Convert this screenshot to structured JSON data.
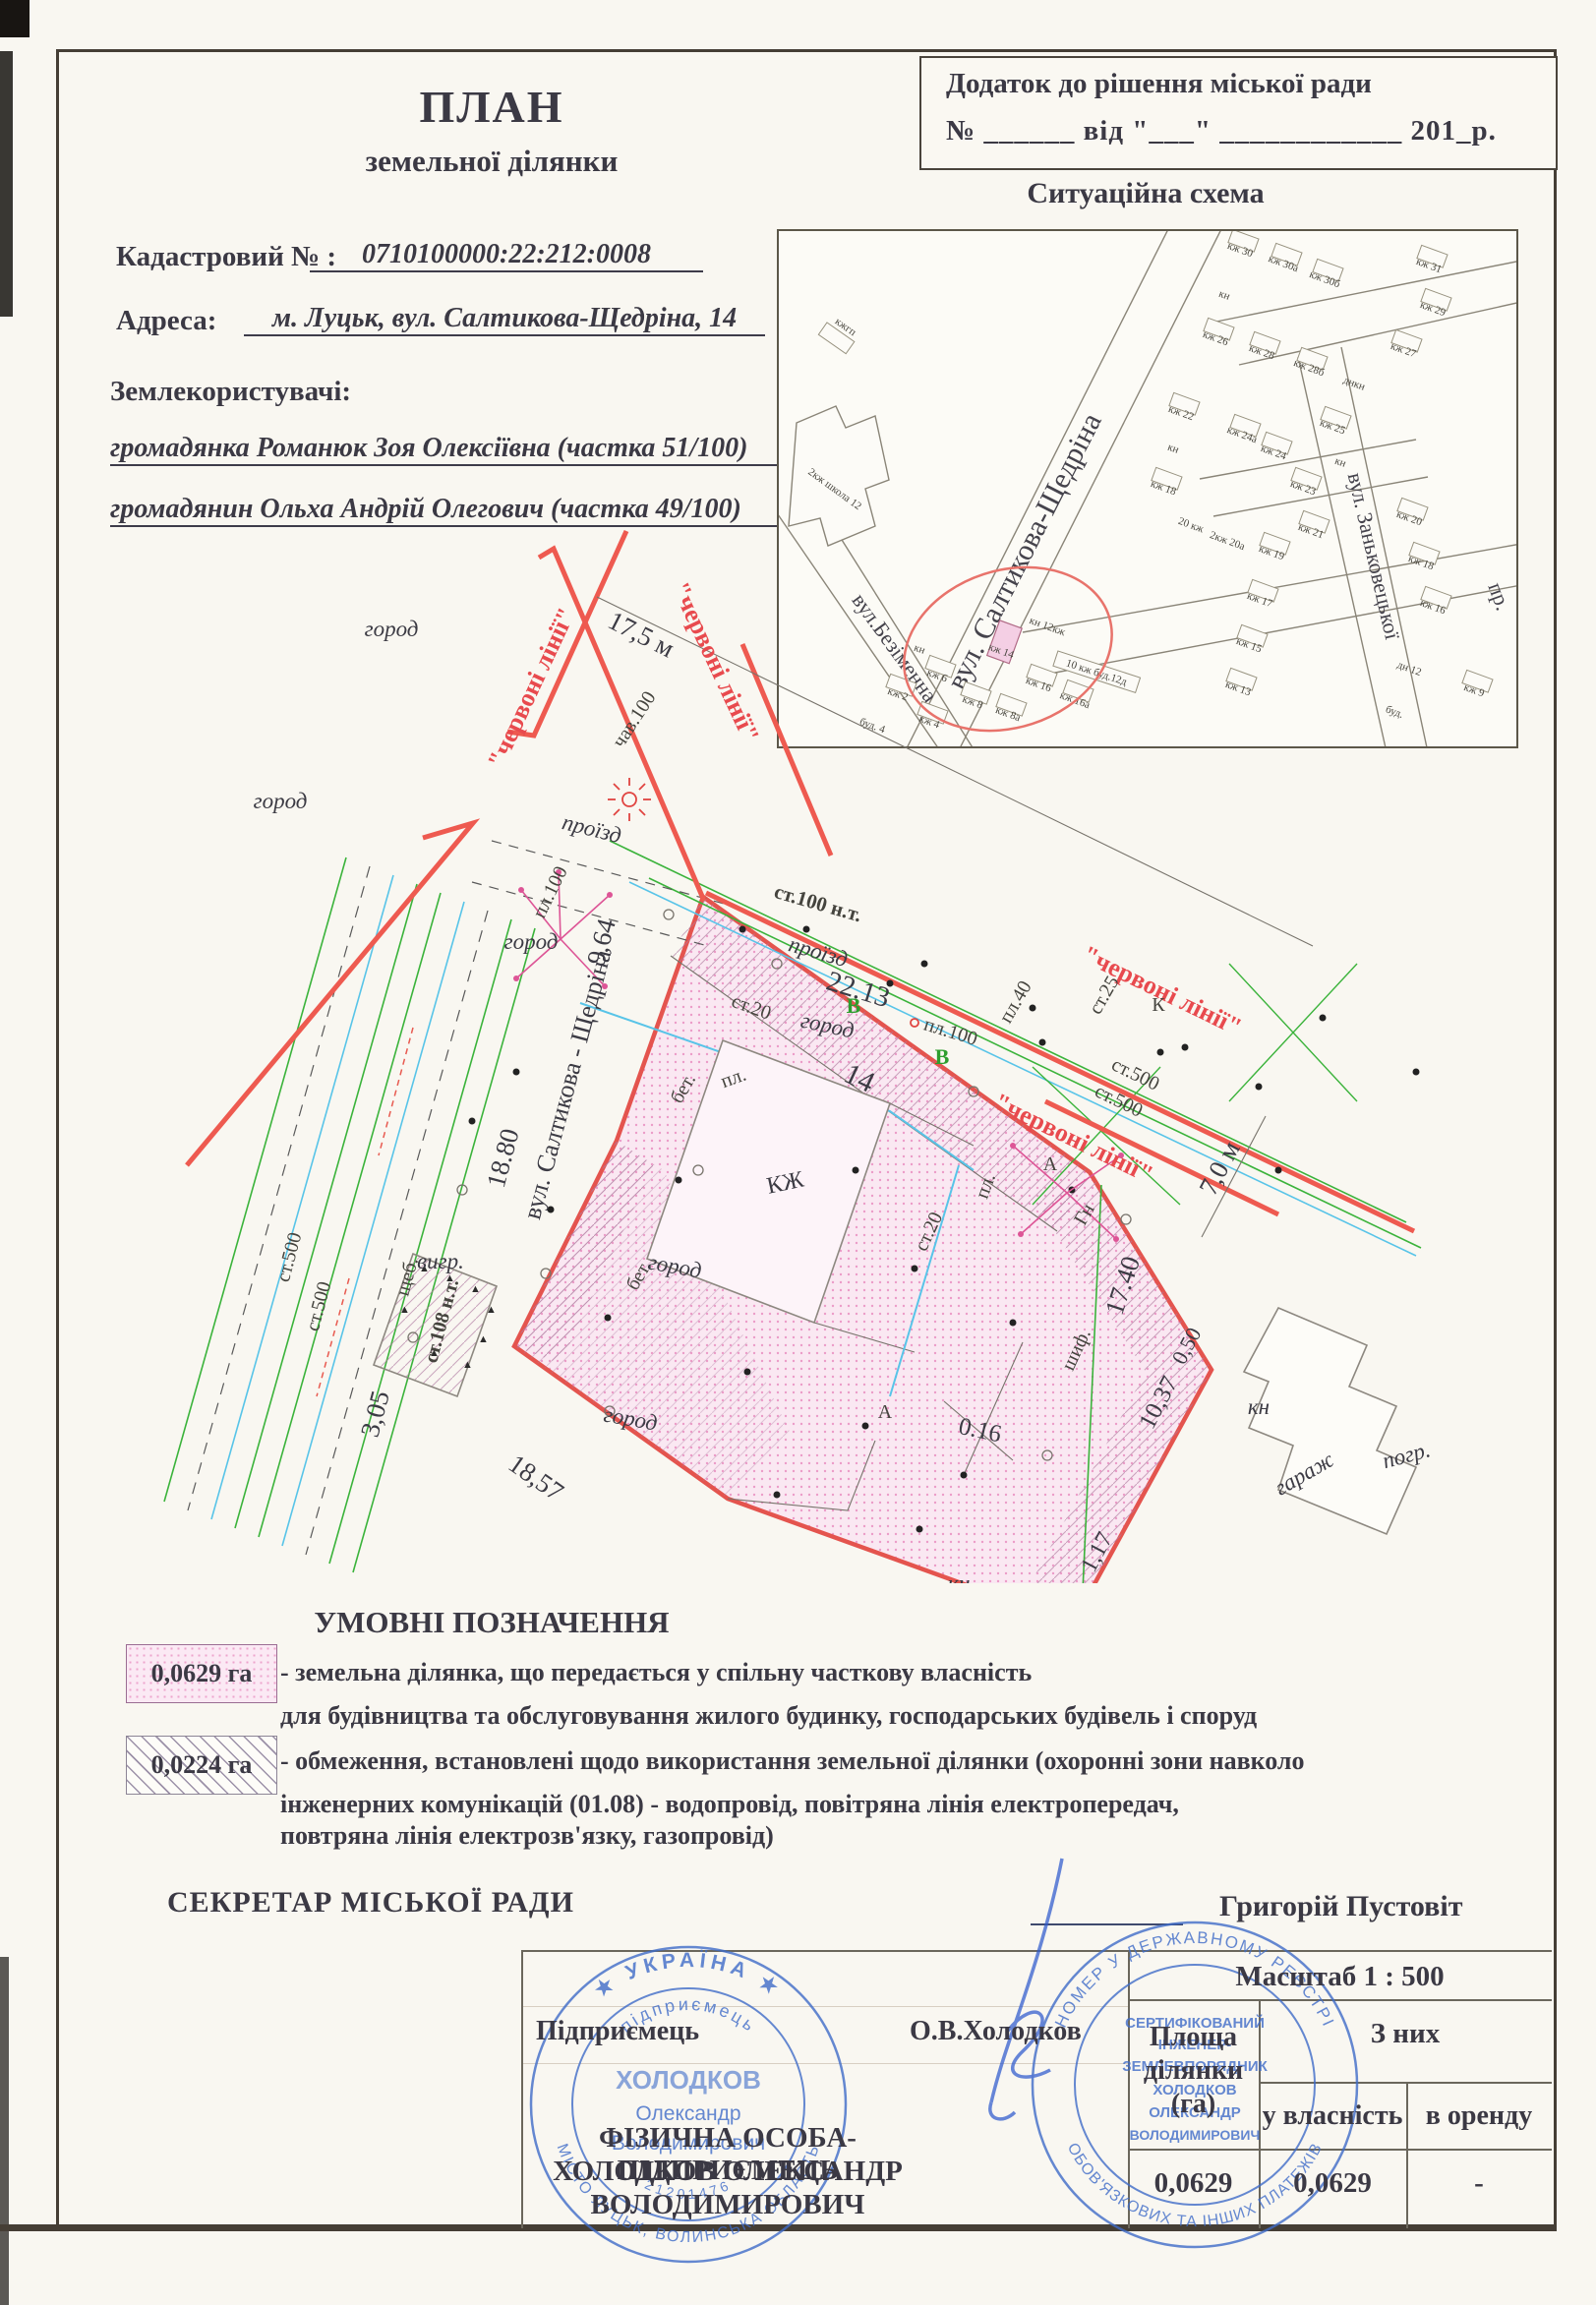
{
  "doc": {
    "title1": "ПЛАН",
    "title2": "земельної ділянки",
    "annex_line1": "Додаток до рішення міської ради",
    "annex_line2": "№ ______ від \"___\" ____________ 201_р.",
    "cadastral_label": "Кадастровий № :",
    "cadastral_value": "0710100000:22:212:0008",
    "address_label": "Адреса:",
    "address_value": "м. Луцьк, вул. Салтикова-Щедріна, 14",
    "landusers_label": "Землекористувачі:",
    "landuser1": "громадянка Романюк Зоя Олексіївна (частка 51/100)",
    "landuser2": "громадянин Ольха Андрій Олегович (частка 49/100)"
  },
  "scheme": {
    "title": "Ситуаційна схема",
    "streets": {
      "saltykova": "вул. Салтикова-Щедріна",
      "bezimenna": "вул.Безіменна",
      "zankovetska": "вул. Заньковецької",
      "pr": "пр."
    },
    "school": "2кж школа 12",
    "kzhgp": "кжгп",
    "houses": [
      "кж 30",
      "кж 30а",
      "кж 30б",
      "кж 31",
      "кн",
      "кж 26",
      "кж 28",
      "кж 28б",
      "днкн",
      "кж 27",
      "кж 29",
      "кж 22",
      "кн",
      "кж 24а",
      "кж 24",
      "кж 25",
      "кн",
      "кж 23",
      "кж 18",
      "20 кж",
      "2кж 20а",
      "кж 21",
      "кж 14",
      "кж 16",
      "кж 16а",
      "кн 12кж",
      "10 кж буд.12д",
      "кж 6",
      "кж 8",
      "кж 8а",
      "кн",
      "кж 2",
      "кж 4",
      "буд. 4",
      "кж 19",
      "кж 17",
      "кж 15",
      "кж 13",
      "кж 20",
      "кж 18",
      "кж 16",
      "дн 12",
      "буд.",
      "кж 9"
    ]
  },
  "plan": {
    "red": "\"червоні лінії\"",
    "street": "вул. Салтикова - Щедріна",
    "d175": "17,5 м",
    "d964": "9,64",
    "d1880": "18.80",
    "d305": "3,05",
    "d2213": "22.13",
    "d1857": "18,57",
    "d1740": "17.40",
    "d1037": "10,37",
    "d050": "0,50",
    "d117": "1,17",
    "d016": "0.16",
    "d70": "7,0 м",
    "n14": "14",
    "kzh": "КЖ",
    "gorod": "город",
    "proizd": "проїзд",
    "st100": "ст.100 н.т.",
    "pl100": "пл.100",
    "chav100": "чав.100",
    "st20": "ст.20",
    "st25": "ст.25",
    "pl40": "пл.40",
    "st500": "ст.500",
    "scheb": "щеб.",
    "st108": "ст.108 н.т.",
    "bet": "бет.",
    "vygr": "вигр.",
    "pl": "пл.",
    "shif": "шиф.",
    "gn": "Гн",
    "kn": "кн",
    "garazh": "гараж",
    "pogr": "погр.",
    "A": "А",
    "K": "К",
    "V": "В"
  },
  "legend": {
    "title": "УМОВНІ ПОЗНАЧЕННЯ",
    "item1_area": "0,0629 га",
    "item1_line1": "- земельна ділянка, що передається у спільну часткову власність",
    "item1_line2": "для будівництва та обслуговування жилого будинку, господарських будівель і споруд",
    "item2_area": "0,0224 га",
    "item2_line1": "- обмеження, встановлені щодо використання земельної ділянки (охоронні зони навколо",
    "item2_line2": "інженерних комунікацій (01.08) - водопровід, повітряна лінія електропередач,",
    "item2_line3": "повтряна лінія електрозв'язку, газопровід)"
  },
  "signoff": {
    "secretary_label": "СЕКРЕТАР МІСЬКОЇ РАДИ",
    "secretary_name": "Григорій Пустовіт"
  },
  "table": {
    "scale": "Масштаб 1 : 500",
    "area_l1": "Площа",
    "area_l2": "ділянки",
    "area_l3": "(га)",
    "of_them": "З них",
    "ownership": "у власність",
    "lease": "в оренду",
    "entrepreneur_label": "Підприємець",
    "entrepreneur_sig": "О.В.Холодков",
    "fop_line1": "ФІЗИЧНА ОСОБА-ПІДПРИЄМЕЦЬ",
    "fop_line2": "ХОЛОДКОВ ОЛЕКСАНДР",
    "fop_line3": "ВОЛОДИМИРОВИЧ",
    "area_value": "0,0629",
    "ownership_value": "0,0629",
    "lease_value": "-"
  },
  "stamps": {
    "s1_ring_top": "★ УКРАЇНА ★",
    "s1_ring_bottom": "МІСТО ЛУЦЬК, ВОЛИНСЬКА ОБЛАСТЬ",
    "s1_inner_top": "підприємець",
    "s1_inner_bottom": "21201476",
    "s1_c1": "ХОЛОДКОВ",
    "s1_c2": "Олександр",
    "s1_c3": "Володимирович",
    "s2_ring_top": "НОМЕР У ДЕРЖАВНОМУ РЕЄСТРІ",
    "s2_ring_bottom": "ОБОВ'ЯЗКОВИХ ТА ІНШИХ ПЛАТЕЖІВ",
    "s2_c1": "СЕРТИФІКОВАНИЙ",
    "s2_c2": "ІНЖЕНЕР-",
    "s2_c3": "ЗЕМЛЕВПОРЯДНИК",
    "s2_c4": "ХОЛОДКОВ",
    "s2_c5": "ОЛЕКСАНДР",
    "s2_c6": "ВОЛОДИМИРОВИЧ"
  },
  "colors": {
    "red_line": "#ee5a50",
    "plot_pink": "#fae8f2",
    "green": "#3bb33b",
    "cyan": "#58c4e8",
    "stamp_blue": "#3f6cc8"
  }
}
